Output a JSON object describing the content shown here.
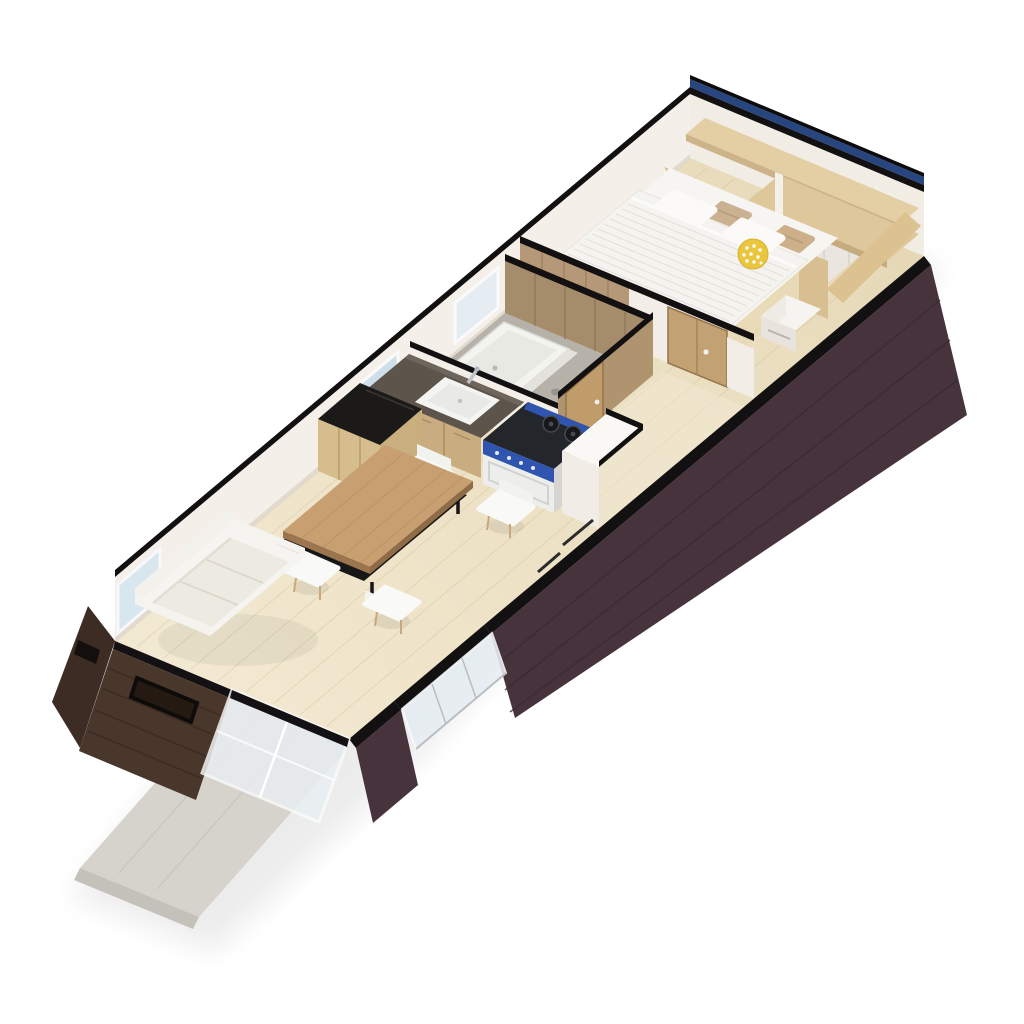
{
  "scene": {
    "title": "3D isometric floor plan render of a long studio cabin",
    "view": "axonometric top-down, unit rotated diagonally from lower-left to upper-right",
    "background": "#ffffff"
  },
  "palette": {
    "background": "#ffffff",
    "floor": "#ebdfc0",
    "floor_grain": "#c9b48c",
    "platform": "#e8d8b0",
    "wall_white": "#f4f0e9",
    "wall_cut": "#131011",
    "wall_dark": "#46333b",
    "end_wall_wood": "#4a372b",
    "corner_wood": "#3c2c24",
    "window_band_navy": "#27457f",
    "glass": "#e6edf2",
    "deck": "#d6d3cc",
    "wood_light": "#e4cfa4",
    "wood_medium": "#b59877",
    "wood_dark": "#96744c",
    "door_wood": "#c2a172",
    "counter_top": "#5d544b",
    "cabinet_wood": "#c9ac80",
    "stove_blue": "#2f55b0",
    "stove_top": "#23262b",
    "pillow_yellow": "#eac63f",
    "pebble": "#b6b1a9",
    "tub": "#f3f3f0",
    "sofa": "#f6f4f0",
    "cushion": "#edeae2",
    "chair": "#f9f9f7",
    "chair_leg": "#c8a87c",
    "island_top": "#1c1a18",
    "table_wood": "#c89f70",
    "bed_linen": "#f5f3ef",
    "headboard_wood": "#d9bd8c"
  },
  "rooms": [
    {
      "name": "bedroom",
      "position": "top-right end",
      "furniture": [
        "double-bed-striped-duvet",
        "white-pillows",
        "tan-pillows",
        "yellow-polkadot-pillow",
        "wood-headboard",
        "overbed-wall-shelf",
        "white-wardrobe",
        "white-nightstand",
        "slatted-wood-bench"
      ]
    },
    {
      "name": "bathroom",
      "position": "middle",
      "furniture": [
        "white-bathtub",
        "pebble-stone-floor",
        "wood-wall-paneling",
        "wood-door",
        "window"
      ]
    },
    {
      "name": "kitchen",
      "position": "middle",
      "furniture": [
        "wood-base-cabinets",
        "dark-countertop",
        "white-sink",
        "chrome-faucet",
        "blue-gas-range",
        "window"
      ]
    },
    {
      "name": "dining",
      "position": "center-left",
      "furniture": [
        "wood-storage-cabinet-black-top",
        "wood-dining-table-black-frame",
        "white-shell-chair",
        "white-shell-chair",
        "white-shell-chair",
        "white-shell-chair"
      ]
    },
    {
      "name": "living",
      "position": "bottom-left end",
      "furniture": [
        "white-three-seat-sofa"
      ]
    },
    {
      "name": "exterior",
      "position": "bottom-left and edges",
      "furniture": [
        "concrete-deck",
        "sliding-glass-doors",
        "dark-wood-siding",
        "window-slot"
      ]
    }
  ]
}
